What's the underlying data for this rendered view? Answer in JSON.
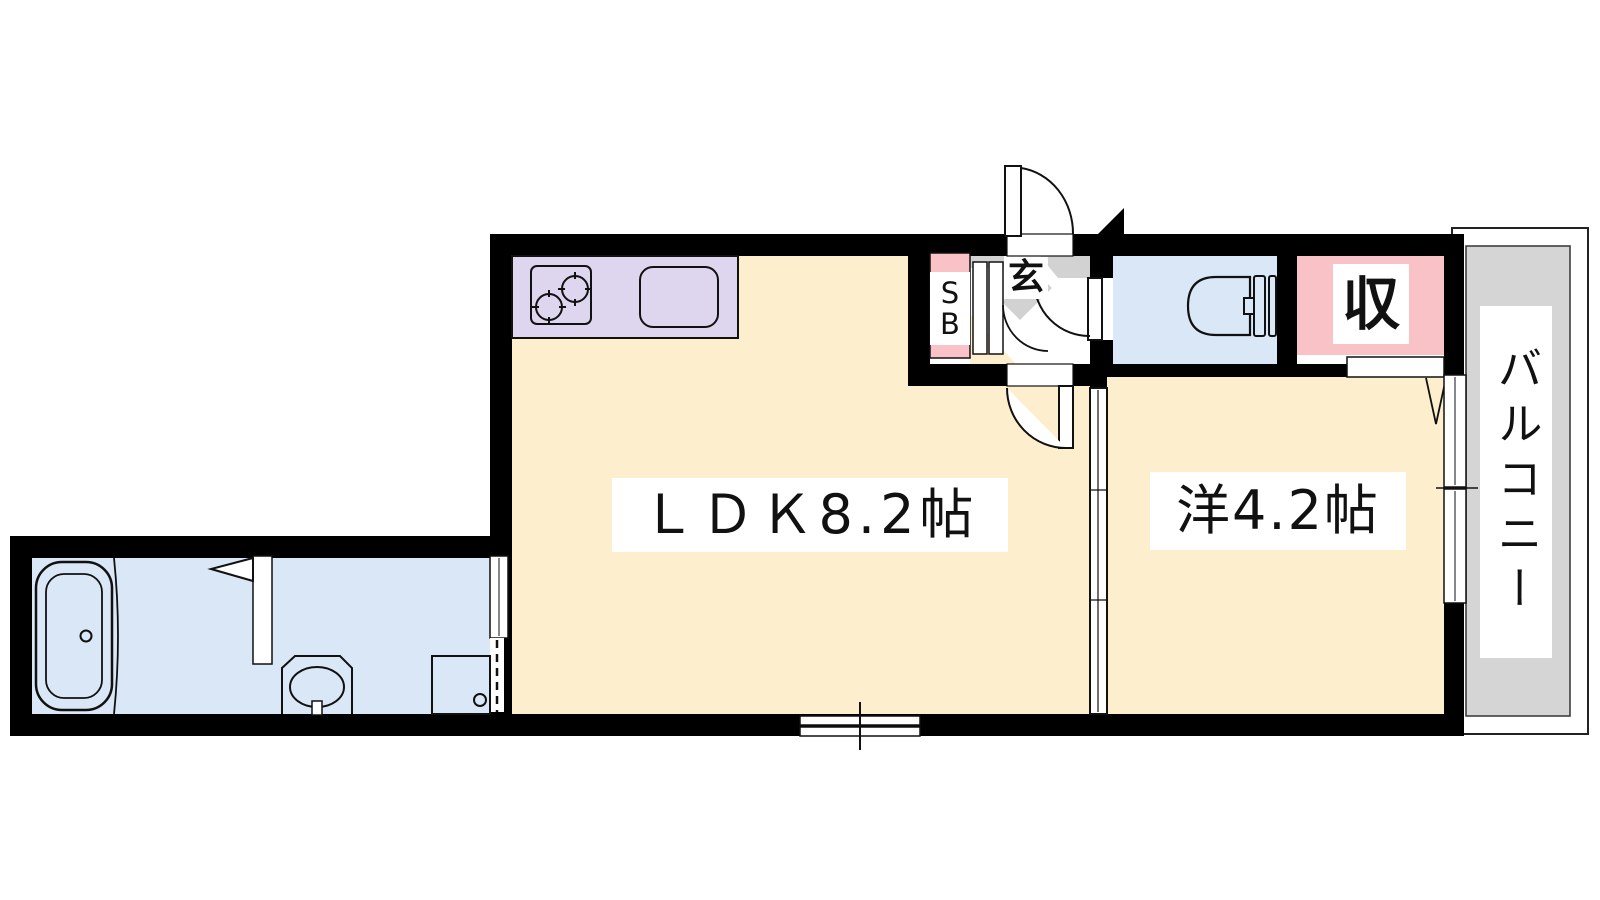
{
  "floorplan": {
    "rooms": {
      "ldk_label": "ＬＤＫ8.2帖",
      "western_room_label": "洋4.2帖",
      "balcony_label": "バルコニー",
      "closet_label": "収",
      "entrance_label": "玄",
      "shoe_box_line1": "S",
      "shoe_box_line2": "B"
    },
    "colors": {
      "floor_cream": "#fdefcd",
      "kitchen_lavender": "#ded5ef",
      "wet_area_blue": "#d9e7f7",
      "accent_pink": "#f9c2c7",
      "balcony_gray": "#d5d5d5",
      "step_gray": "#d2d2d2",
      "wall_black": "#000000",
      "line_black": "#111111"
    }
  }
}
